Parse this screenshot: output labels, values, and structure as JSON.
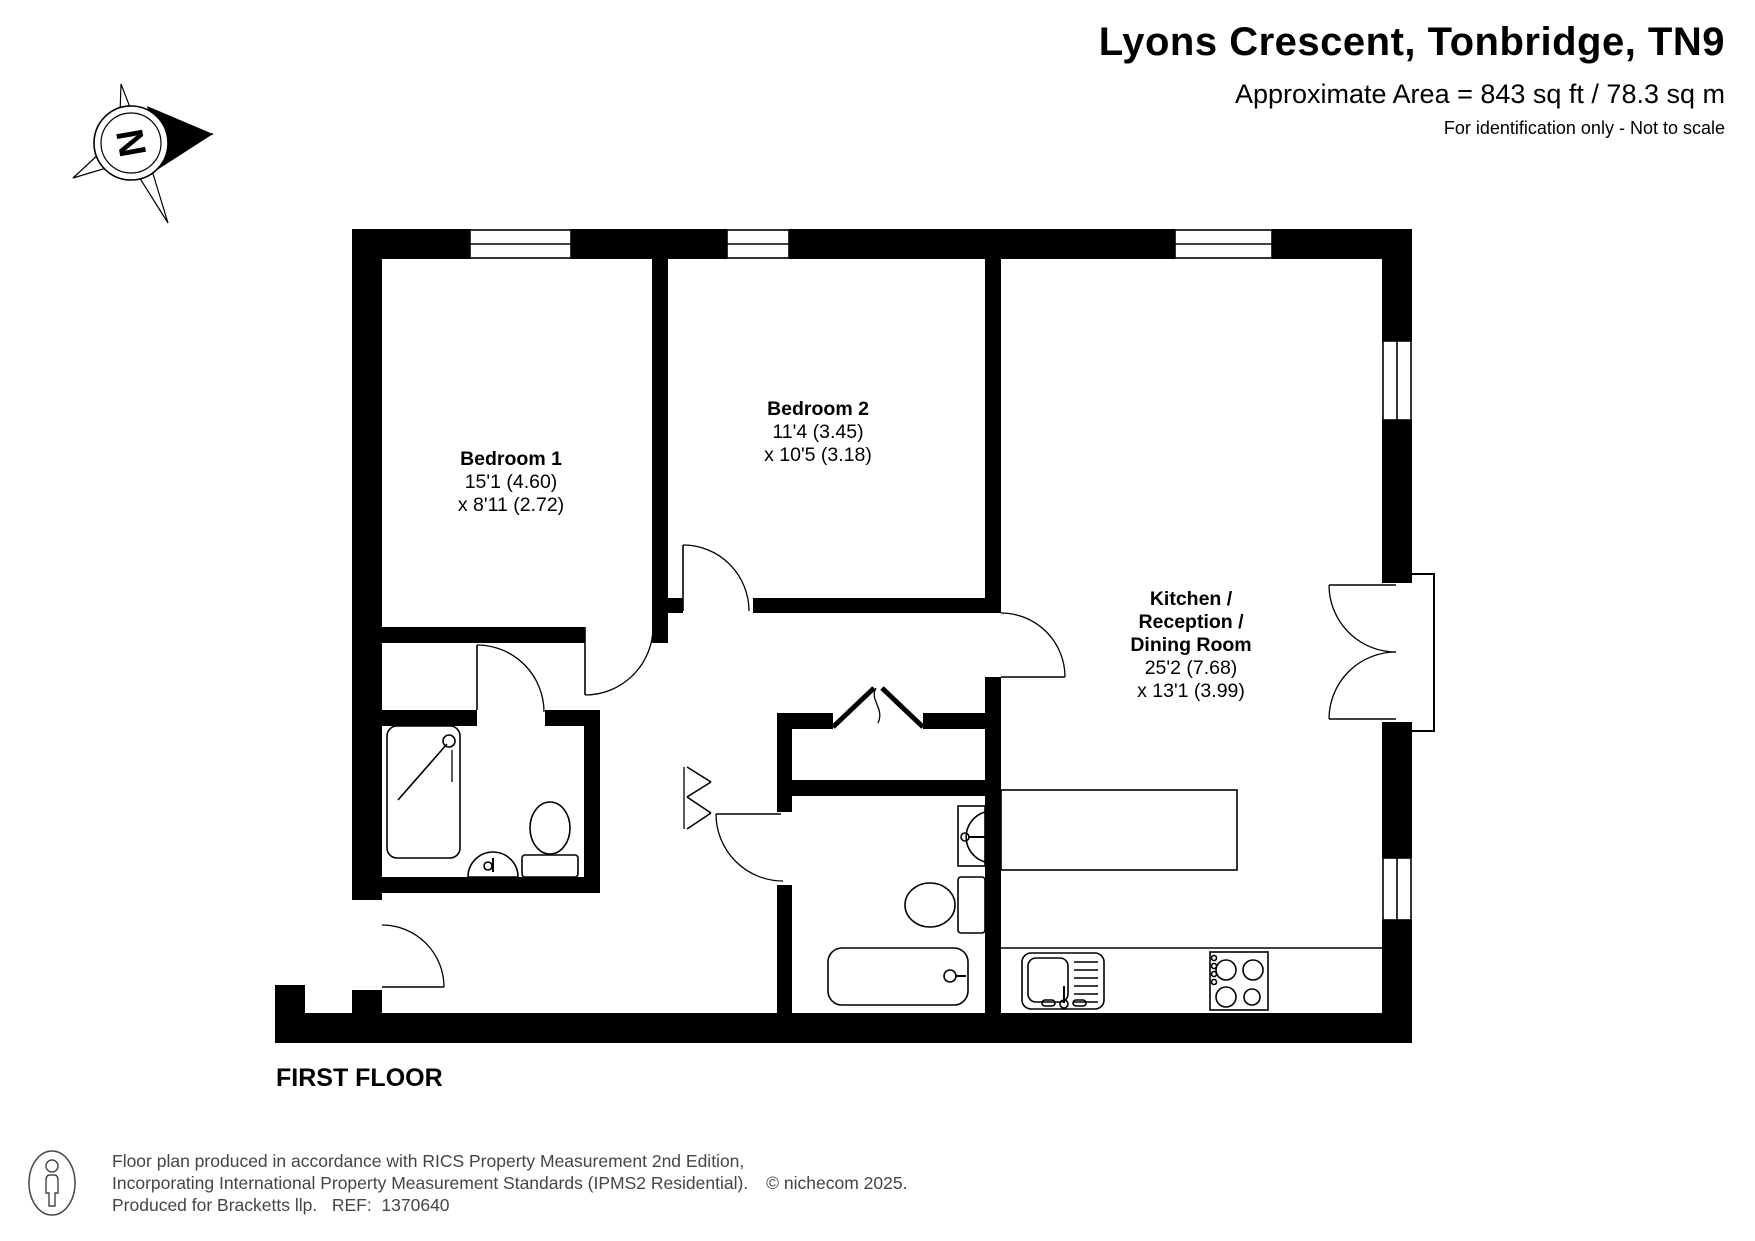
{
  "header": {
    "title": "Lyons Crescent, Tonbridge, TN9",
    "area": "Approximate Area = 843 sq ft / 78.3 sq m",
    "note": "For identification only - Not to scale"
  },
  "compass": {
    "label": "N"
  },
  "floor_label": "FIRST FLOOR",
  "rooms": [
    {
      "name": "Bedroom 1",
      "dim1": "15'1 (4.60)",
      "dim2": "x 8'11 (2.72)"
    },
    {
      "name": "Bedroom 2",
      "dim1": "11'4 (3.45)",
      "dim2": "x 10'5 (3.18)"
    },
    {
      "name": "Kitchen / Reception / Dining Room",
      "name_lines": [
        "Kitchen /",
        "Reception /",
        "Dining Room"
      ],
      "dim1": "25'2 (7.68)",
      "dim2": "x 13'1 (3.99)"
    }
  ],
  "footer": {
    "line1": "Floor plan produced in accordance with RICS Property Measurement 2nd Edition,",
    "line2": "Incorporating International Property Measurement Standards (IPMS2 Residential).",
    "copyright": "© nichecom 2025.",
    "line3": "Produced for Bracketts llp.   REF:  1370640"
  },
  "colors": {
    "wall": "#000000",
    "line": "#000000",
    "footer_text": "#454545"
  }
}
